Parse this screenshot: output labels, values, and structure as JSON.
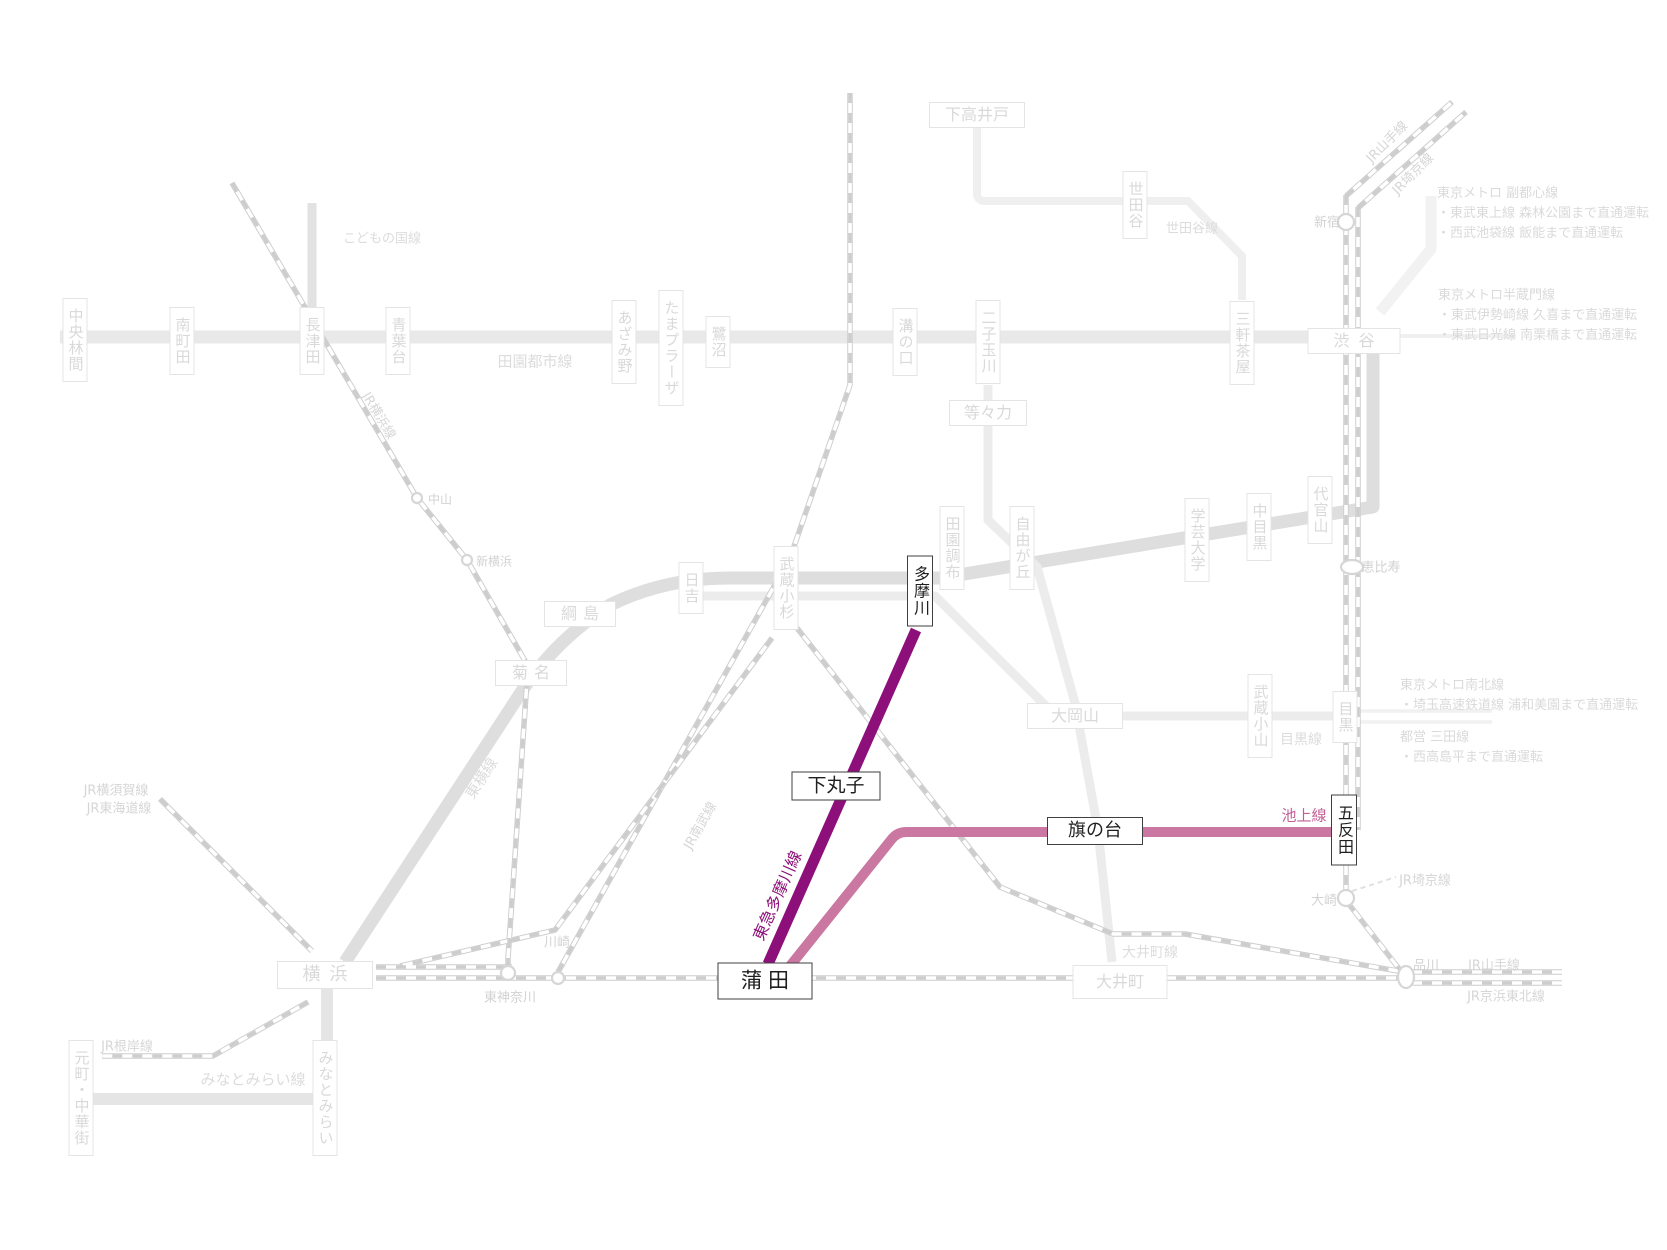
{
  "colors": {
    "tamagawa_line": "#8d0f79",
    "ikegami_line": "#ca78a2",
    "ikegami_label": "#c35f93"
  },
  "lines": {
    "denentoshi": "田園都市線",
    "kodomonokuni": "こどもの国線",
    "setagaya_line": "世田谷線",
    "toyoko": "東横線",
    "meguro_line": "目黒線",
    "oimachi_line": "大井町線",
    "minatomirai_line": "みなとみらい線",
    "ikegami": "池上線",
    "tamagawa": "東急多摩川線",
    "jr_yokohama": "JR横浜線",
    "jr_nambu": "JR南武線",
    "jr_yamanote": "JR山手線",
    "jr_saikyo": "JR埼京線",
    "jr_keihintohoku": "JR京浜東北線",
    "jr_yokosuka": "JR横須賀線",
    "jr_tokaido": "JR東海道線",
    "jr_negishi": "JR根岸線"
  },
  "st": {
    "chuorinkan": "中央林間",
    "minamimachida": "南町田",
    "nagatsuta": "長津田",
    "aobadai": "青葉台",
    "azamino": "あざみ野",
    "tamaplaza": "たまプラーザ",
    "saginuma": "鷺沼",
    "mizonokuchi": "溝の口",
    "futakotamagawa": "二子玉川",
    "sangenjaya": "三軒茶屋",
    "shibuya": "渋谷",
    "shimotakaido": "下高井戸",
    "setagaya": "世田谷",
    "todoroki": "等々力",
    "daikanyama": "代官山",
    "nakameguro": "中目黒",
    "gakugeidaigaku": "学芸大学",
    "denenchofu": "田園調布",
    "jiyugaoka": "自由が丘",
    "okayama": "大岡山",
    "musashikoyama": "武蔵小山",
    "meguro": "目黒",
    "musashikosugi": "武蔵小杉",
    "hiyoshi": "日吉",
    "tsunashima": "綱島",
    "kikuna": "菊名",
    "yokohama": "横浜",
    "motomachi": "元町・中華街",
    "minatomirai": "みなとみらい",
    "tamagawa": "多摩川",
    "shimomaruko": "下丸子",
    "kamata": "蒲田",
    "hatanodai": "旗の台",
    "gotanda": "五反田",
    "shinjuku": "新宿",
    "ebisu": "恵比寿",
    "osaki": "大崎",
    "shinagawa": "品川",
    "oimachi": "大井町",
    "higashikanagawa": "東神奈川",
    "kawasaki": "川崎",
    "nakayama": "中山",
    "shinyokohama": "新横浜"
  },
  "annotations": {
    "fukutoshin": [
      "東京メトロ 副都心線",
      "・東武東上線 森林公園まで直通運転",
      "・西武池袋線 飯能まで直通運転"
    ],
    "hanzomon": [
      "東京メトロ半蔵門線",
      "・東武伊勢崎線 久喜まで直通運転",
      "・東武日光線 南栗橋まで直通運転"
    ],
    "namboku": [
      "東京メトロ南北線",
      "・埼玉高速鉄道線 浦和美園まで直通運転"
    ],
    "mita": [
      "都営 三田線",
      "・西高島平まで直通運転"
    ]
  }
}
